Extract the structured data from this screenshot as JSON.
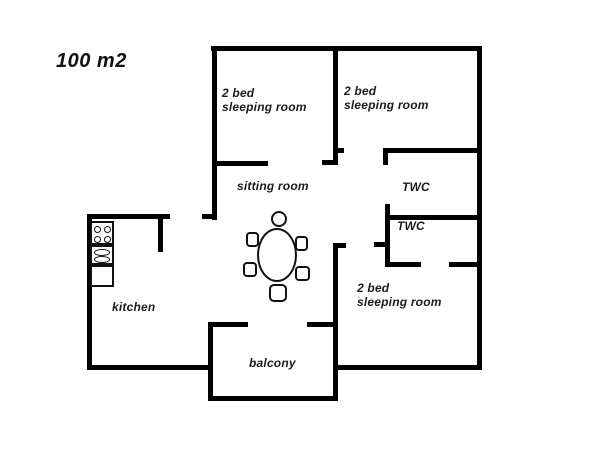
{
  "plan": {
    "title": "100 m2"
  },
  "rooms": {
    "bedroom_top_left": {
      "line1": "2 bed",
      "line2": "sleeping room"
    },
    "bedroom_top_right": {
      "line1": "2 bed",
      "line2": "sleeping room"
    },
    "bedroom_bottom_right": {
      "line1": "2 bed",
      "line2": "sleeping room"
    },
    "sitting_room": {
      "label": "sitting room"
    },
    "twc_upper": {
      "label": "TWC"
    },
    "twc_lower": {
      "label": "TWC"
    },
    "kitchen": {
      "label": "kitchen"
    },
    "balcony": {
      "label": "balcony"
    }
  },
  "furniture": {
    "dining_table": {
      "shape": "oval",
      "chairs": 6
    },
    "stove": {
      "burners": 4
    },
    "sink": {
      "basins": 2
    },
    "counter": {
      "type": "empty-counter"
    }
  },
  "colors": {
    "wall": "#000000",
    "text": "#1c1c1c",
    "background": "#ffffff"
  }
}
